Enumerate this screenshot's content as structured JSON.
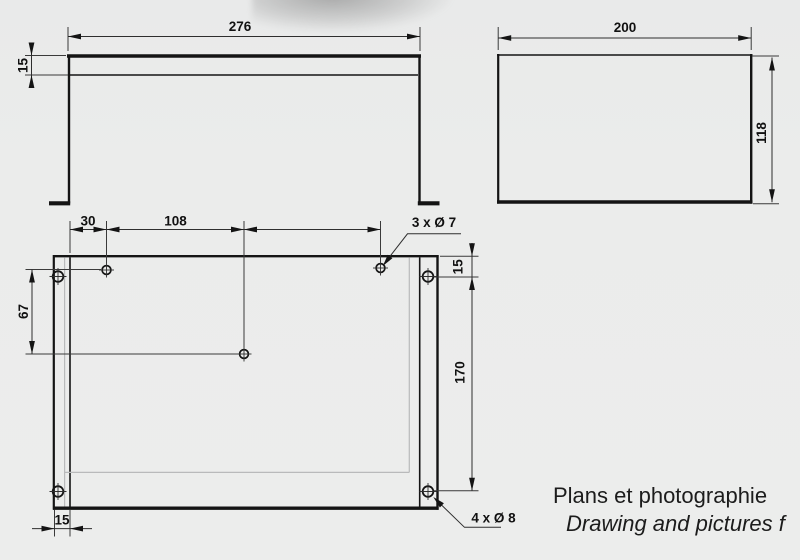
{
  "drawing": {
    "front_view": {
      "width": "276",
      "flange_height": "15"
    },
    "side_view": {
      "depth": "200",
      "height": "118"
    },
    "plan_view": {
      "edge_to_first_hole": "30",
      "hole_spacing": "108",
      "hole_row_offset": "67",
      "corner_hole_top_offset": "15",
      "corner_hole_spacing": "170",
      "foot_width": "15",
      "small_holes_callout": "3 x Ø 7",
      "large_holes_callout": "4 x Ø 8"
    },
    "caption": {
      "french": "Plans et photographie",
      "english": "Drawing and pictures f"
    },
    "colors": {
      "background": "#ebeceb",
      "part_line": "#141414",
      "hidden_line": "#b9babb",
      "dimension_line": "#2e2e2e",
      "text": "#111111"
    }
  }
}
